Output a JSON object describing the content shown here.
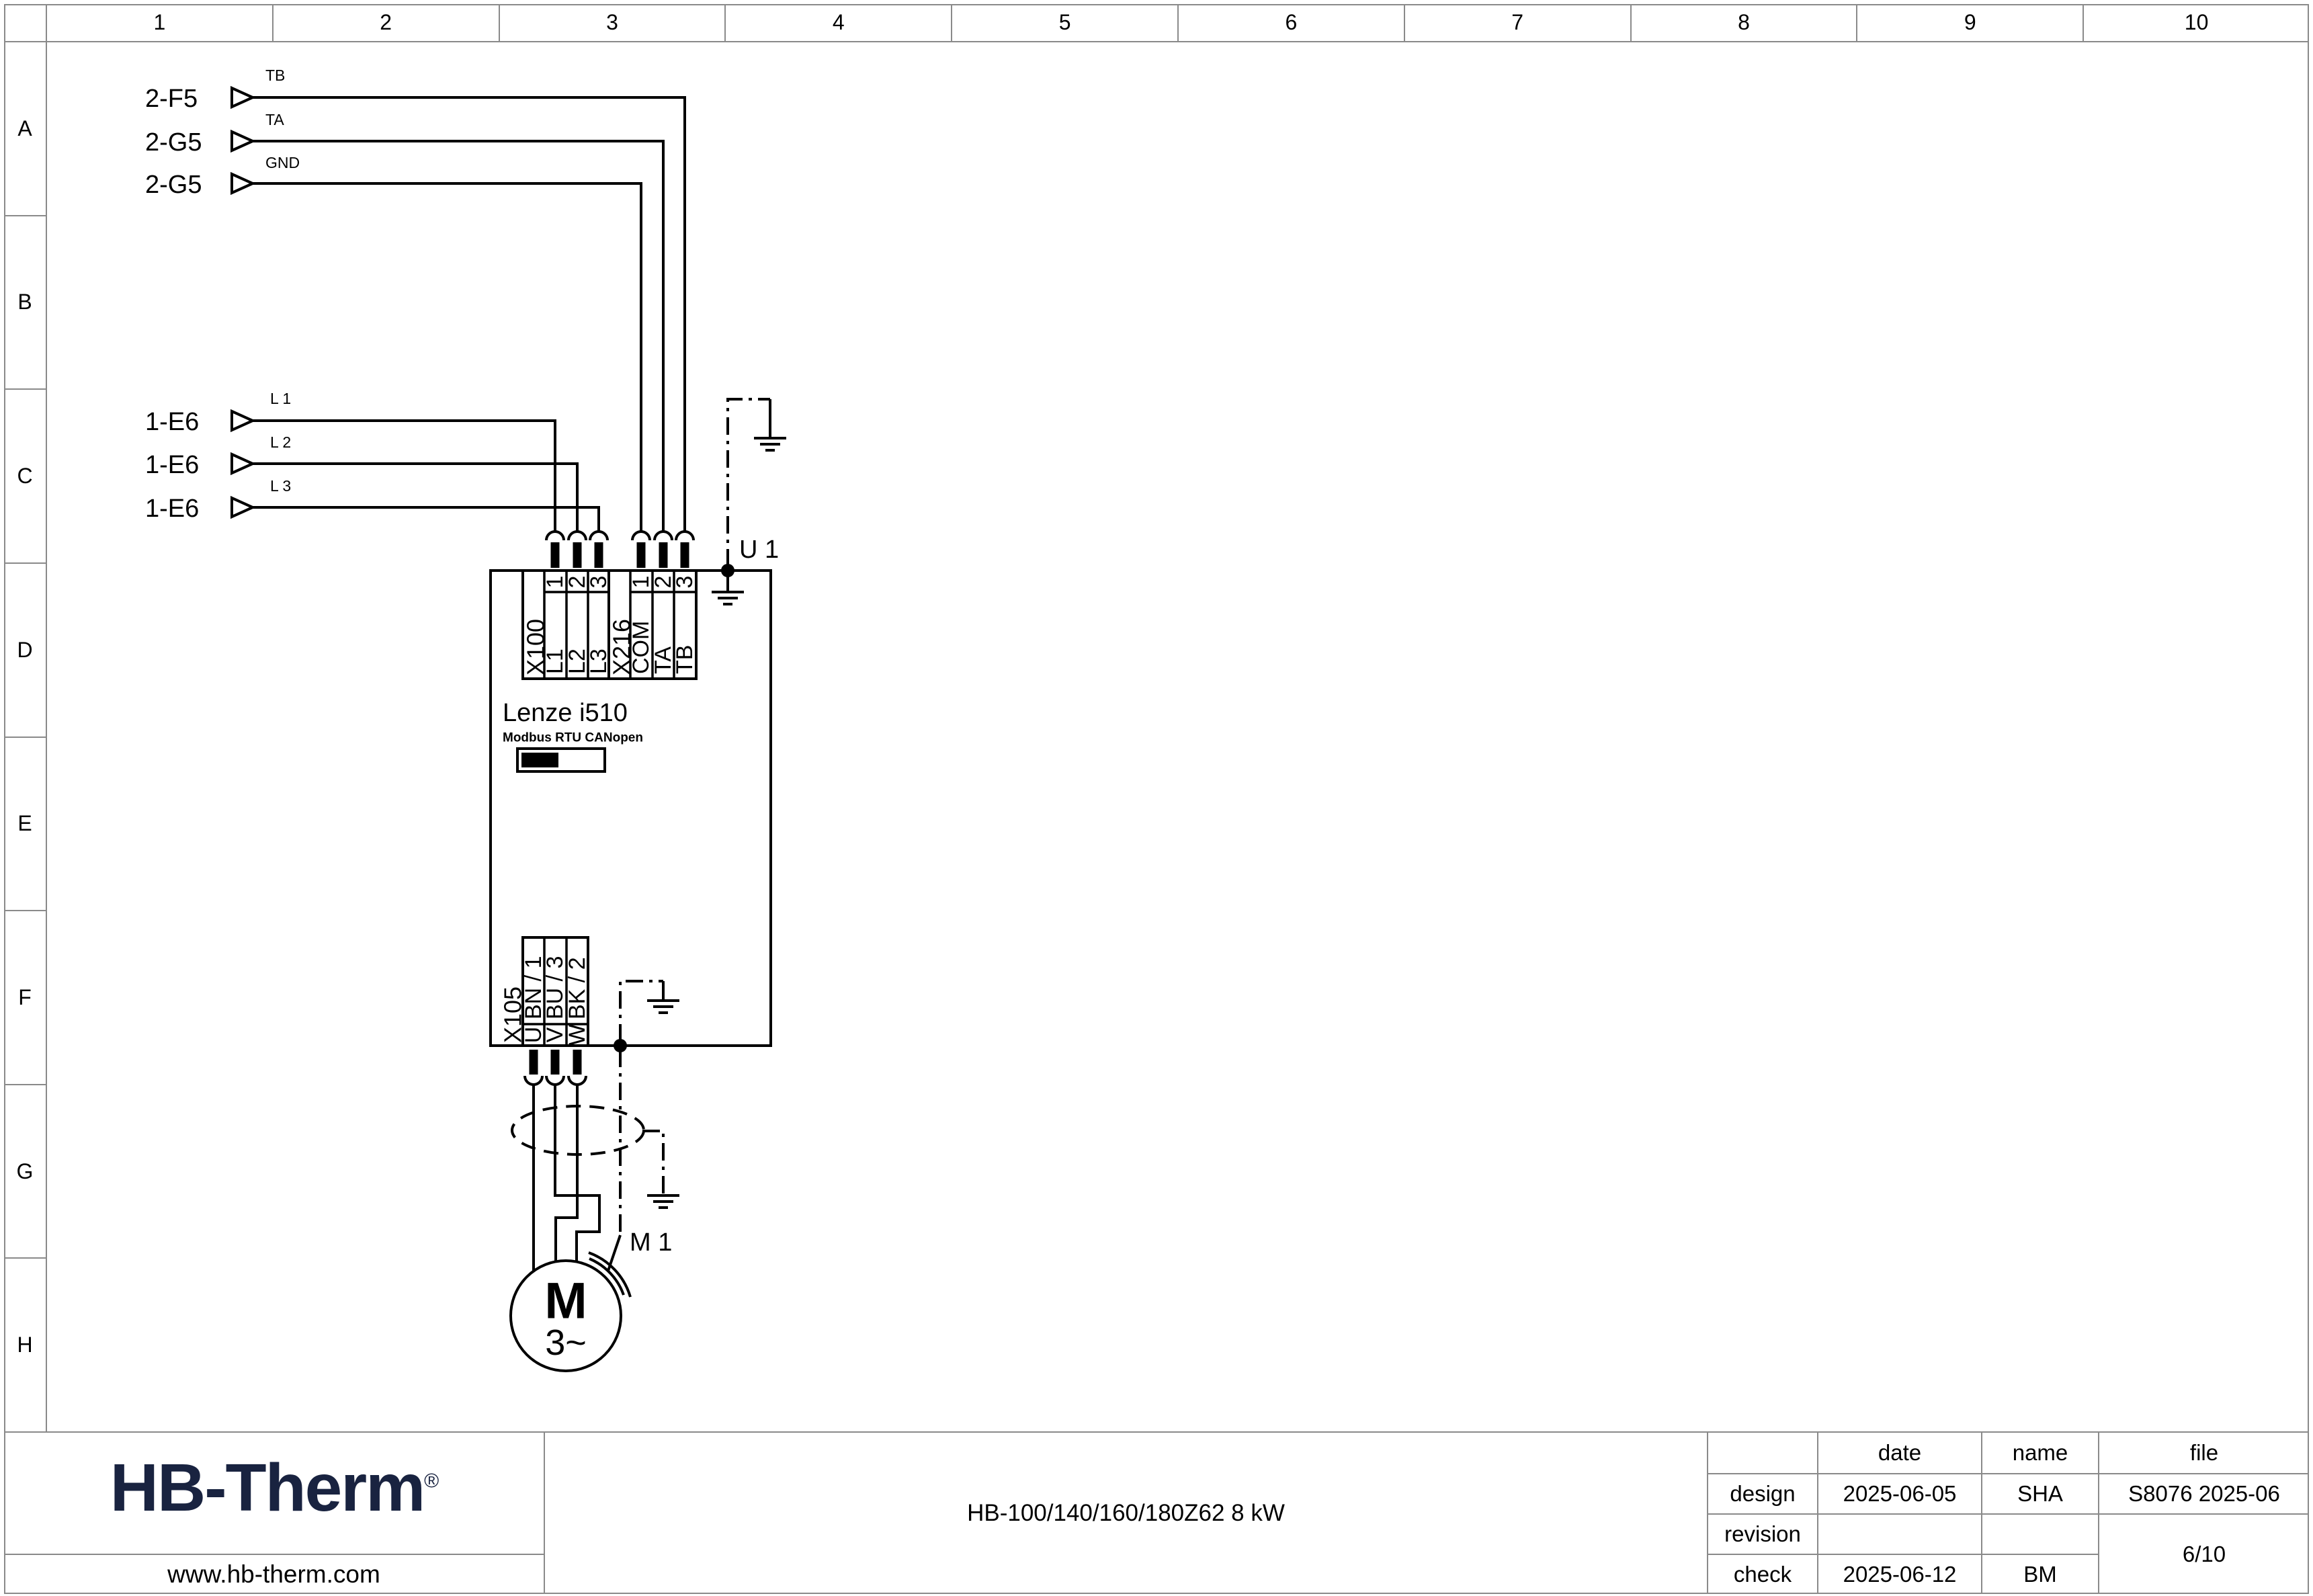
{
  "ruler": {
    "columns": [
      "1",
      "2",
      "3",
      "4",
      "5",
      "6",
      "7",
      "8",
      "9",
      "10"
    ],
    "rows": [
      "A",
      "B",
      "C",
      "D",
      "E",
      "F",
      "G",
      "H"
    ]
  },
  "connectors": {
    "comm": [
      {
        "ref": "2-F5",
        "signal": "TB"
      },
      {
        "ref": "2-G5",
        "signal": "TA"
      },
      {
        "ref": "2-G5",
        "signal": "GND"
      }
    ],
    "power": [
      {
        "ref": "1-E6",
        "signal": "L 1"
      },
      {
        "ref": "1-E6",
        "signal": "L 2"
      },
      {
        "ref": "1-E6",
        "signal": "L 3"
      }
    ]
  },
  "drive": {
    "designation": "U 1",
    "product": "Lenze i510",
    "fieldbus": "Modbus RTU CANopen",
    "x100": {
      "name": "X100",
      "pins": [
        "1",
        "2",
        "3"
      ],
      "signals": [
        "L1",
        "L2",
        "L3"
      ]
    },
    "x216": {
      "name": "X216",
      "pins": [
        "1",
        "2",
        "3"
      ],
      "signals": [
        "COM",
        "TA",
        "TB"
      ]
    },
    "x105": {
      "name": "X105",
      "pins": [
        "U",
        "V",
        "W"
      ],
      "signals": [
        "BN / 1",
        "BU / 3",
        "BK / 2"
      ]
    }
  },
  "motor": {
    "designation": "M 1",
    "symbol": "M",
    "phase": "3~"
  },
  "title_block": {
    "logo": "HB-Therm",
    "logo_mark": "®",
    "website": "www.hb-therm.com",
    "doc_title": "HB-100/140/160/180Z62 8 kW",
    "headers": {
      "date": "date",
      "name": "name",
      "file": "file"
    },
    "design": {
      "label": "design",
      "date": "2025-06-05",
      "name": "SHA",
      "file": "S8076 2025-06"
    },
    "revision": {
      "label": "revision",
      "date": "",
      "name": ""
    },
    "check": {
      "label": "check",
      "date": "2025-06-12",
      "name": "BM"
    },
    "page": "6/10"
  },
  "colors": {
    "ink": "#000000",
    "frame": "#8a8a8a",
    "logo": "#192340",
    "paper": "#ffffff"
  }
}
